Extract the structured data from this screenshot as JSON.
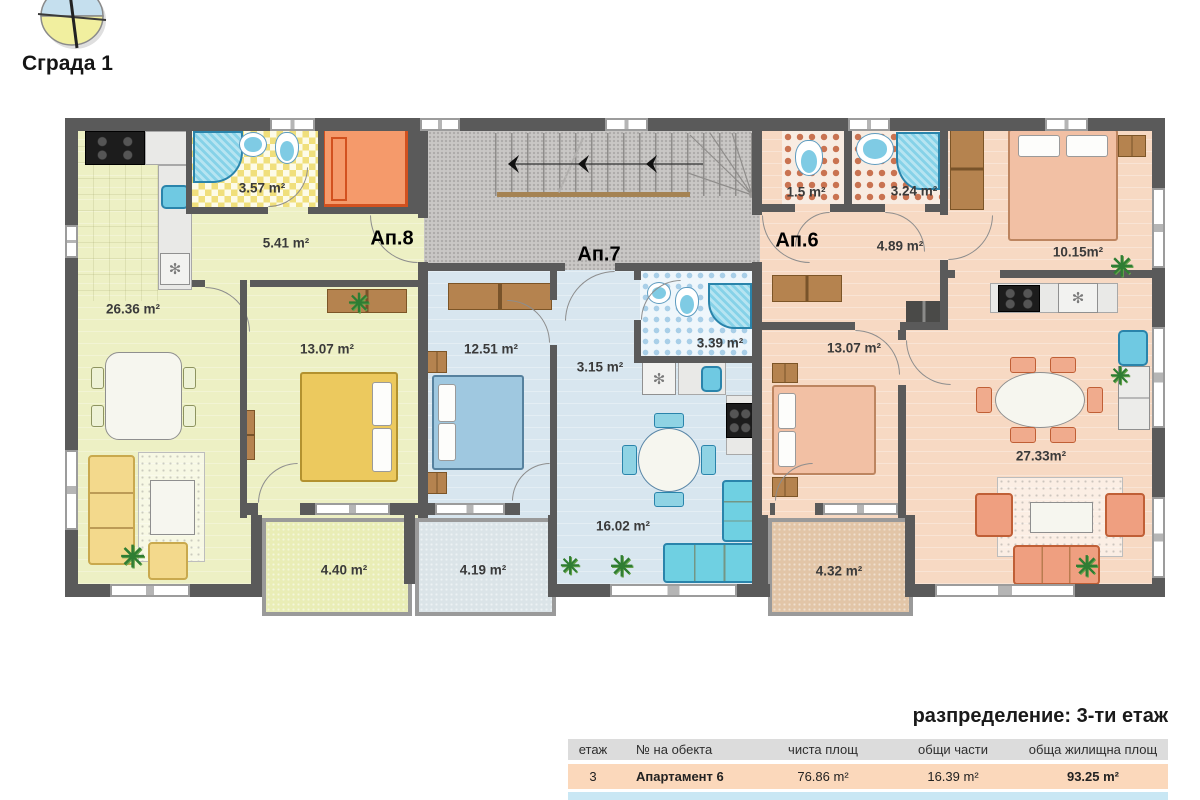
{
  "header": {
    "building_label": "Сграда 1"
  },
  "plan": {
    "ap8": {
      "label": "Ап.8",
      "living_area": "26.36 m²",
      "bath_area": "3.57 m²",
      "hall_area": "5.41 m²",
      "bedroom_area": "13.07 m²",
      "balcony_area": "4.40 m²"
    },
    "ap7": {
      "label": "Ап.7",
      "bedroom_area": "12.51 m²",
      "hall_area": "3.15 m²",
      "bath_area": "3.39 m²",
      "living_area": "16.02 m²",
      "balcony_area": "4.19 m²"
    },
    "ap6": {
      "label": "Ап.6",
      "wc_area": "1.5 m²",
      "bath_area": "3.24 m²",
      "hall_area": "4.89 m²",
      "bedroom_top_area": "10.15m²",
      "bedroom_area": "13.07 m²",
      "living_area": "27.33m²",
      "balcony_area": "4.32 m²"
    }
  },
  "distribution": {
    "title": "разпределение: 3-ти етаж",
    "headers": {
      "floor": "етаж",
      "unit": "№ на обекта",
      "net": "чиста площ",
      "common": "общи части",
      "total": "обща жилищна площ"
    },
    "rows": [
      {
        "floor": "3",
        "unit": "Апартамент 6",
        "net": "76.86 m²",
        "common": "16.39 m²",
        "total": "93.25 m²"
      },
      {
        "floor": "3",
        "unit": "Апартамент 7",
        "net": "46.15 m²",
        "common": "10.16 m²",
        "total": "56.31 m²"
      }
    ]
  },
  "icons": {
    "plant": "✳",
    "fan": "✻"
  },
  "colors": {
    "wall": "#5a5a5a",
    "ap8_floor": "#edf0c4",
    "ap7_floor": "#d8e6ef",
    "ap6_floor": "#f7d9c3",
    "stair_core": "#c9c7c5",
    "elevator": "#f59a6b",
    "elevator_border": "#d2511f",
    "table_header": "#dcdcdc",
    "row_ap6": "#fbd8bb",
    "row_ap7": "#c9e7f4"
  }
}
